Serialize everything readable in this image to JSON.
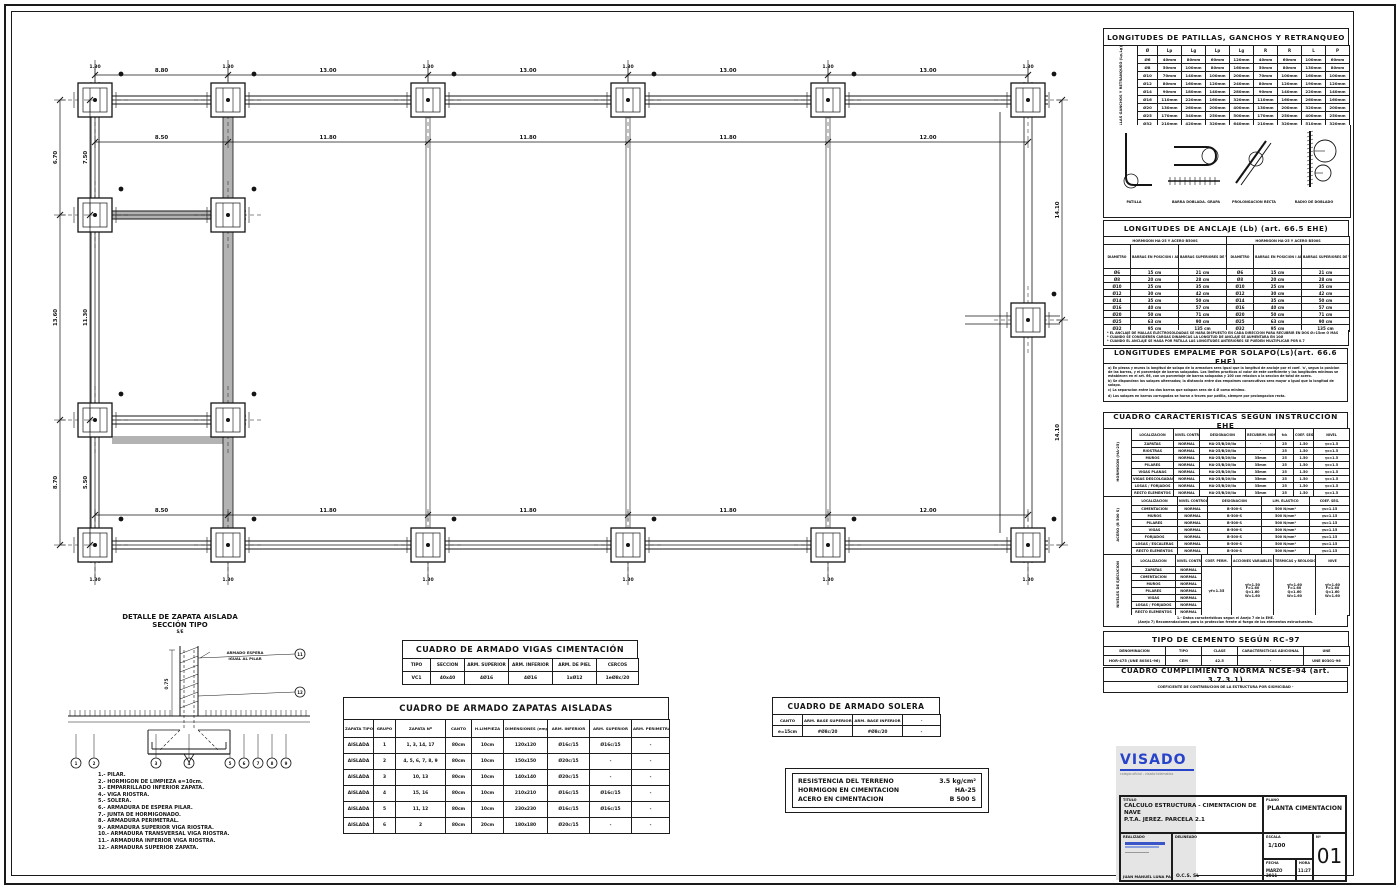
{
  "sheet": {
    "number": "01"
  },
  "plan": {
    "top_outer_dims": [
      "8.80",
      "13.00",
      "13.00",
      "13.00",
      "13.00"
    ],
    "top_inner_dims": [
      "8.50",
      "11.80",
      "11.80",
      "11.80",
      "12.00"
    ],
    "bottom_inner_dims": [
      "8.50",
      "11.80",
      "11.80",
      "11.80",
      "12.00"
    ],
    "left_outer_dims": [
      "6.70",
      "13.60",
      "8.70"
    ],
    "left_inner_dims": [
      "7.50",
      "11.30",
      "5.50"
    ],
    "right_dims": [
      "14.10",
      "14.10"
    ],
    "footing_width_label": "1.30"
  },
  "detail": {
    "title_line1": "DETALLE DE ZAPATA AISLADA",
    "title_line2": "SECCIÓN TIPO",
    "title_line3": "S/E",
    "dim_label": "0.75",
    "note_lines": [
      "ARMADO ESPERA",
      "IGUAL AL PILAR"
    ],
    "legend": [
      "1.- PILAR.",
      "2.- HORMIGON DE LIMPIEZA e=10cm.",
      "3.- EMPARRILLADO INFERIOR ZAPATA.",
      "4.- VIGA RIOSTRA.",
      "5.- SOLERA.",
      "6.- ARMADURA DE ESPERA PILAR.",
      "7.- JUNTA DE HORMIGONADO.",
      "8.- ARMADURA PERIMETRAL.",
      "9.- ARMADURA SUPERIOR VIGA RIOSTRA.",
      "10.- ARMADURA TRANSVERSAL VIGA RIOSTRA.",
      "11.- ARMADURA INFERIOR VIGA RIOSTRA.",
      "12.- ARMADURA SUPERIOR ZAPATA."
    ]
  },
  "vigas_table": {
    "title": "CUADRO DE ARMADO VIGAS CIMENTACIÓN",
    "columns": [
      "TIPO",
      "SECCION",
      "ARM. SUPERIOR",
      "ARM. INFERIOR",
      "ARM. DE PIEL",
      "CERCOS"
    ],
    "rows": [
      [
        "VC1",
        "40x40",
        "4Ø16",
        "4Ø16",
        "1xØ12",
        "1eØ8c/20"
      ]
    ]
  },
  "zapatas_table": {
    "title": "CUADRO DE ARMADO ZAPATAS AISLADAS",
    "columns": [
      "ZAPATA TIPO",
      "GRUPO",
      "ZAPATA Nº",
      "CANTO",
      "H.LIMPIEZA",
      "DIMENSIONES (emparrillado)",
      "ARM. INFERIOR",
      "ARM. SUPERIOR",
      "ARM. PERIMETRAL"
    ],
    "rows": [
      [
        "AISLADA",
        "1",
        "1, 3, 14, 17",
        "80cm",
        "10cm",
        "120x120",
        "Ø16c/15",
        "Ø16c/15",
        "-"
      ],
      [
        "AISLADA",
        "2",
        "4, 5, 6, 7, 8, 9",
        "80cm",
        "10cm",
        "150x150",
        "Ø20c/15",
        "-",
        "-"
      ],
      [
        "AISLADA",
        "3",
        "10, 13",
        "80cm",
        "10cm",
        "140x140",
        "Ø20c/15",
        "-",
        "-"
      ],
      [
        "AISLADA",
        "4",
        "15, 16",
        "80cm",
        "10cm",
        "210x210",
        "Ø16c/15",
        "Ø16c/15",
        "-"
      ],
      [
        "AISLADA",
        "5",
        "11, 12",
        "80cm",
        "10cm",
        "230x230",
        "Ø16c/15",
        "Ø16c/15",
        "-"
      ],
      [
        "AISLADA",
        "6",
        "2",
        "80cm",
        "20cm",
        "180x180",
        "Ø20c/15",
        "-",
        "-"
      ]
    ]
  },
  "solera_table": {
    "title": "CUADRO DE ARMADO SOLERA",
    "columns": [
      "CANTO",
      "ARM. BASE SUPERIOR",
      "ARM. BASE INFERIOR",
      "-"
    ],
    "rows": [
      [
        "e=15cm",
        "#Ø8c/20",
        "#Ø8c/20",
        "-"
      ]
    ]
  },
  "resistencia": {
    "rows": [
      [
        "RESISTENCIA DEL TERRENO",
        "3.5 kg/cm²"
      ],
      [
        "HORMIGON EN CIMENTACION",
        "HA-25"
      ],
      [
        "ACERO EN CIMENTACION",
        "B 500 S"
      ]
    ]
  },
  "patillas": {
    "title": "LONGITUDES DE PATILLAS, GANCHOS Y RETRANQUEO",
    "side_label": [
      "PATILLAS",
      "GANCHOS",
      "Y",
      "RETRANQUEO",
      "(Lp,Lg)"
    ],
    "columns": [
      "Ø",
      "Lp",
      "Lg",
      "Lp",
      "Lg",
      "R",
      "R",
      "L",
      "P"
    ],
    "rows": [
      [
        "Ø6",
        "40mm",
        "80mm",
        "60mm",
        "120mm",
        "40mm",
        "60mm",
        "100mm",
        "60mm"
      ],
      [
        "Ø8",
        "50mm",
        "100mm",
        "80mm",
        "160mm",
        "50mm",
        "80mm",
        "130mm",
        "80mm"
      ],
      [
        "Ø10",
        "70mm",
        "140mm",
        "100mm",
        "200mm",
        "70mm",
        "100mm",
        "160mm",
        "100mm"
      ],
      [
        "Ø12",
        "80mm",
        "160mm",
        "120mm",
        "240mm",
        "80mm",
        "120mm",
        "190mm",
        "120mm"
      ],
      [
        "Ø14",
        "90mm",
        "180mm",
        "140mm",
        "280mm",
        "90mm",
        "140mm",
        "220mm",
        "140mm"
      ],
      [
        "Ø16",
        "110mm",
        "220mm",
        "160mm",
        "320mm",
        "110mm",
        "160mm",
        "260mm",
        "160mm"
      ],
      [
        "Ø20",
        "130mm",
        "260mm",
        "200mm",
        "400mm",
        "130mm",
        "200mm",
        "320mm",
        "200mm"
      ],
      [
        "Ø25",
        "170mm",
        "340mm",
        "250mm",
        "500mm",
        "170mm",
        "250mm",
        "400mm",
        "250mm"
      ],
      [
        "Ø32",
        "210mm",
        "420mm",
        "320mm",
        "640mm",
        "210mm",
        "320mm",
        "510mm",
        "320mm"
      ],
      [
        "Ø40",
        "270mm",
        "540mm",
        "400mm",
        "800mm",
        "270mm",
        "400mm",
        "640mm",
        "400mm"
      ]
    ],
    "captions": [
      "PATILLA",
      "BARRA DOBLADA. GRAPA",
      "PROLONGACION RECTA",
      "RADIO DE DOBLADO"
    ]
  },
  "anclaje": {
    "title": "LONGITUDES DE ANCLAJE (Lb)  (art. 66.5 EHE)",
    "band": "HORMIGON HA-25 Y ACERO B500S",
    "columns": [
      "DIAMETRO",
      "BARRAS EN POSICION I ADHER. BUENA (PATILLA, GANCHO Y ANCLAJE)",
      "BARRAS SUPERIORES DE VIGAS (POSICION II) Y DEMAS"
    ],
    "rows": [
      [
        "Ø6",
        "15 cm",
        "21 cm"
      ],
      [
        "Ø8",
        "20 cm",
        "28 cm"
      ],
      [
        "Ø10",
        "25 cm",
        "35 cm"
      ],
      [
        "Ø12",
        "30 cm",
        "42 cm"
      ],
      [
        "Ø14",
        "35 cm",
        "50 cm"
      ],
      [
        "Ø16",
        "40 cm",
        "57 cm"
      ],
      [
        "Ø20",
        "50 cm",
        "71 cm"
      ],
      [
        "Ø25",
        "63 cm",
        "90 cm"
      ],
      [
        "Ø32",
        "95 cm",
        "135 cm"
      ]
    ],
    "notes": [
      "* EL ANCLAJE DE MALLAS ELECTROSOLDADAS SE HARA DISPUESTO EN CADA DIRECCION PARA RECUBRIR EN DOS Ø>15cm O MAS",
      "* CUANDO SE CONSIDEREN CARGAS DINAMICAS LA LONGITUD DE ANCLAJE SE AUMENTARA EN 10Ø",
      "* CUANDO EL ANCLAJE SE HAGA POR PATILLA LAS LONGITUDES ANTERIORES SE PUEDEN MULTIPLICAR POR 0.7"
    ]
  },
  "solapo": {
    "title": "LONGITUDES EMPALME POR SOLAPO(Ls)(art. 66.6 EHE)",
    "notes": [
      "a) En piezas y muros la longitud de solapo de la armadura sera igual que la longitud de anclaje por el coef. 'a', segun la posicion de las barras, y el porcentaje de barras solapadas. Los limites practicos al valor de este coeficiente y las longitudes minimas se establecen en el art. 66, con un porcentaje de barras solapadas y 100 con relacion a la seccion de total de acero.",
      "b) Se dispondran los solapes alternados; la distancia entre dos empalmes consecutivos sera mayor o igual que la longitud de solapo.",
      "c) La separacion entre las dos barras que solapan sera de 4 Ø como minimo.",
      "d) Los solapes en barras corrugadas se haran a traves por patilla, siempre por prolongacion recta."
    ]
  },
  "caracteristicas": {
    "title": "CUADRO CARÁCTERISTICAS SEGÚN INSTRUCCIÓN EHE",
    "hormigon": {
      "label": [
        "HORMIGON",
        "(HA-25)"
      ],
      "headers": [
        "LOCALIZACION",
        "NIVEL CONTROL",
        "DESIGNACION",
        "RECUBRIM. NOMINAL",
        "fck",
        "COEF. SEG.",
        "NIVEL"
      ],
      "rows": [
        [
          "ZAPATAS",
          "NORMAL",
          "HA-25/B/20/IIa",
          "-",
          "25",
          "1.50",
          "γc=1.5"
        ],
        [
          "RIOSTRAS",
          "NORMAL",
          "HA-25/B/20/IIa",
          "-",
          "25",
          "1.50",
          "γc=1.5"
        ],
        [
          "MUROS",
          "NORMAL",
          "HA-25/B/20/IIa",
          "35mm",
          "25",
          "1.50",
          "γc=1.5"
        ],
        [
          "PILARES",
          "NORMAL",
          "HA-25/B/20/IIa",
          "35mm",
          "25",
          "1.50",
          "γc=1.5"
        ],
        [
          "VIGAS PLANAS",
          "NORMAL",
          "HA-25/B/20/IIa",
          "35mm",
          "25",
          "1.50",
          "γc=1.5"
        ],
        [
          "VIGAS DESCOLGADAS",
          "NORMAL",
          "HA-25/B/20/IIa",
          "35mm",
          "25",
          "1.50",
          "γc=1.5"
        ],
        [
          "LOSAS / FORJADOS",
          "NORMAL",
          "HA-25/B/20/IIa",
          "35mm",
          "25",
          "1.50",
          "γc=1.5"
        ],
        [
          "RESTO ELEMENTOS",
          "NORMAL",
          "HA-25/B/20/IIa",
          "35mm",
          "25",
          "1.50",
          "γc=1.5"
        ]
      ]
    },
    "acero": {
      "label": [
        "ACERO",
        "(B 500 S)"
      ],
      "headers": [
        "LOCALIZACION",
        "NIVEL CONTROL",
        "DESIGNACION",
        "LIM. ELASTICO",
        "COEF. SEG."
      ],
      "rows": [
        [
          "CIMENTACION",
          "NORMAL",
          "B-500-S",
          "500 N/mm²",
          "γs=1.15"
        ],
        [
          "MUROS",
          "NORMAL",
          "B-500-S",
          "500 N/mm²",
          "γs=1.15"
        ],
        [
          "PILARES",
          "NORMAL",
          "B-500-S",
          "500 N/mm²",
          "γs=1.15"
        ],
        [
          "VIGAS",
          "NORMAL",
          "B-500-S",
          "500 N/mm²",
          "γs=1.15"
        ],
        [
          "FORJADOS",
          "NORMAL",
          "B-500-S",
          "500 N/mm²",
          "γs=1.15"
        ],
        [
          "LOSAS / ESCALERAS",
          "NORMAL",
          "B-500-S",
          "500 N/mm²",
          "γs=1.15"
        ],
        [
          "RESTO ELEMENTOS",
          "NORMAL",
          "B-500-S",
          "500 N/mm²",
          "γs=1.15"
        ]
      ]
    },
    "ejecucion": {
      "label": [
        "NIVELES",
        "DE",
        "EJECUCION"
      ],
      "headers": [
        "LOCALIZACION",
        "NIVEL CONTROL",
        "COEF. PERM.",
        "ACCIONES VARIABLES",
        "TERMICAS y REOLOGICAS",
        "NIVE"
      ],
      "row_labels": [
        "ZAPATAS",
        "CIMENTACION",
        "MUROS",
        "PILARES",
        "VIGAS",
        "LOSAS / FORJADOS",
        "RESTO ELEMENTOS"
      ],
      "nivel": "NORMAL",
      "perm": "γf=1.35",
      "variable": [
        "γf=1.50",
        "F=1.60",
        "Q=1.60",
        "W=1.60"
      ],
      "termicas": [
        "γf=1.60",
        "F=1.60",
        "Q=1.60",
        "W=1.60"
      ],
      "nive": [
        "γf=1.60",
        "F=1.60",
        "Q=1.60",
        "W=1.60"
      ]
    },
    "footnotes": [
      "1.- Datos caracteristicos segun el Anejo 7 de la EHE.",
      "(Anejo 7) Recomendaciones para la proteccion frente al fuego de los elementos estructurales."
    ]
  },
  "cemento": {
    "title": "TIPO DE CEMENTO SEGÚN RC-97",
    "columns": [
      "DENOMINACION",
      "TIPO",
      "CLASE",
      "CARACTERISTICAS ADICIONAL",
      "UNE"
    ],
    "rows": [
      [
        "HOR-475 (UNE 80301-96)",
        "CEM",
        "42.5",
        "-",
        "UNE 80301-96"
      ]
    ]
  },
  "ncse": {
    "title": "CUADRO CUMPLIMIENTO NORMA NCSE-94 (art. 3.7.3.1)",
    "note": "COEFICIENTE DE CONTRIBUCION DE LA ESTRUCTURA POR SISMICIDAD    -"
  },
  "titleblock": {
    "visado": {
      "text": "VISADO",
      "caption": "colegio oficial - visado telematico",
      "color": "#2743c9"
    },
    "labels": {
      "titulo": "TITULO",
      "plano": "PLANO",
      "realizado": "REALIZADO",
      "delineado": "DELINEADO",
      "escala": "ESCALA",
      "fecha": "FECHA",
      "hora": "HORA",
      "numero": "Nº"
    },
    "titulo_lines": [
      "CALCULO ESTRUCTURA - CIMENTACION DE NAVE",
      "P.T.A. JEREZ. PARCELA 2.1"
    ],
    "plano": "PLANTA CIMENTACION",
    "autor": "JUAN MANUEL LUNA PAGOS",
    "empresa": "O.C.S. SL",
    "escala": "1/100",
    "fecha": "MARZO 2011",
    "hora": "11:27",
    "numero": "01"
  }
}
